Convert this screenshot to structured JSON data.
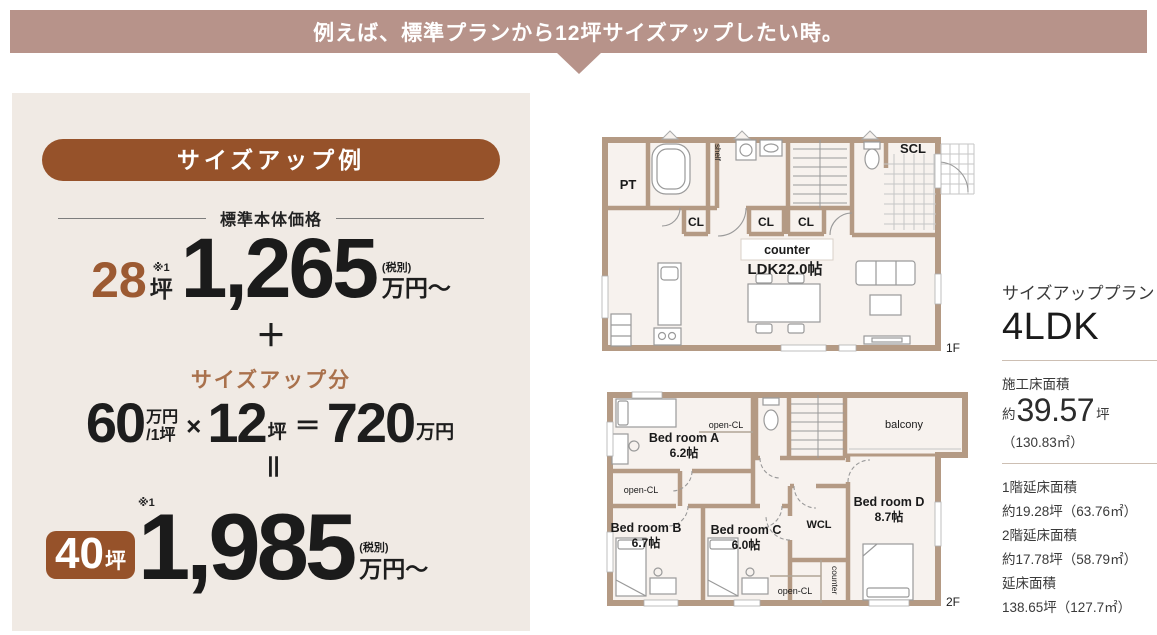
{
  "colors": {
    "banner_mauve": "#b7938a",
    "accent_brown": "#96522a",
    "number_brown": "#9c5a32",
    "sizeup_text_brown": "#a9714c",
    "panel_bg": "#f0eae4",
    "wall_tan": "#b49a84",
    "plan_floor": "#f7f2ee",
    "text_dark": "#333333"
  },
  "banner": {
    "text": "例えば、標準プランから12坪サイズアップしたい時。"
  },
  "example_panel": {
    "title": "サイズアップ例",
    "base_price_label": "標準本体価格",
    "base": {
      "area": "28",
      "note": "※1",
      "area_unit": "坪",
      "price": "1,265",
      "tax_note": "(税別)",
      "price_unit": "万円〜"
    },
    "plus_sign": "＋",
    "sizeup_label": "サイズアップ分",
    "formula": {
      "unit_price": "60",
      "unit_top": "万円",
      "unit_bottom": "/1坪",
      "times": "×",
      "count": "12",
      "count_unit": "坪",
      "equals": "＝",
      "result": "720",
      "result_unit": "万円"
    },
    "vertical_equals": "＝",
    "total": {
      "area": "40",
      "area_unit": "坪",
      "note": "※1",
      "price": "1,985",
      "tax_note": "(税別)",
      "price_unit": "万円〜"
    }
  },
  "floorplan_1f": {
    "floor_label": "1F",
    "pt": "PT",
    "shelf": "shelf",
    "cl": [
      "CL",
      "CL",
      "CL"
    ],
    "counter": "counter",
    "ldk": "LDK22.0帖",
    "scl": "SCL"
  },
  "floorplan_2f": {
    "floor_label": "2F",
    "open_cl_top": "open-CL",
    "bedroom_a": "Bed room A",
    "bedroom_a_size": "6.2帖",
    "balcony": "balcony",
    "open_cl_left": "open-CL",
    "bedroom_b": "Bed room B",
    "bedroom_b_size": "6.7帖",
    "bedroom_c": "Bed room C",
    "bedroom_c_size": "6.0帖",
    "wcl": "WCL",
    "bedroom_d": "Bed room D",
    "bedroom_d_size": "8.7帖",
    "open_cl_bottom": "open-CL",
    "counter": "counter"
  },
  "plan_info": {
    "plan_label": "サイズアッププラン",
    "plan_type": "4LDK",
    "construction_area_label": "施工床面積",
    "approx_prefix": "約",
    "construction_area_value": "39.57",
    "construction_area_unit": "坪",
    "construction_area_m2": "（130.83㎡）",
    "floor_areas": [
      {
        "label": "1階延床面積",
        "value": "約19.28坪（63.76㎡）"
      },
      {
        "label": "2階延床面積",
        "value": "約17.78坪（58.79㎡）"
      },
      {
        "label": "延床面積",
        "value": "138.65坪（127.7㎡）"
      }
    ]
  }
}
